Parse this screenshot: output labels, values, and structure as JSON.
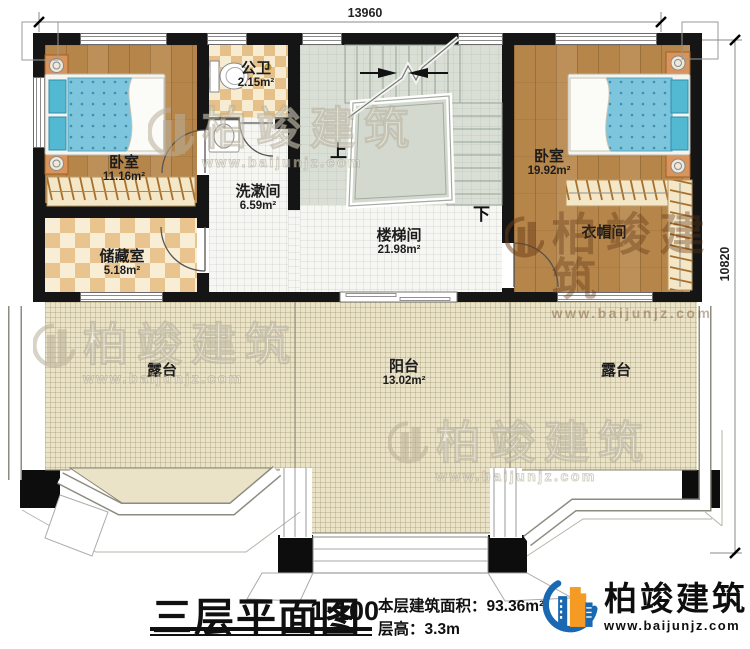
{
  "plan": {
    "title": "三层平面图",
    "scale": "1:100",
    "area_label": "本层建筑面积：",
    "area_value": "93.36m²",
    "height_label": "层高：",
    "height_value": "3.3m",
    "dimensions": {
      "top": "13960",
      "right": "10820"
    },
    "rooms": {
      "bedroom1": {
        "name": "卧室",
        "area": "11.16m²"
      },
      "bath": {
        "name": "公卫",
        "area": "2.15m²"
      },
      "wash": {
        "name": "洗漱间",
        "area": "6.59m²"
      },
      "stairwell": {
        "name": "楼梯间",
        "area": "21.98m²"
      },
      "bedroom2": {
        "name": "卧室",
        "area": "19.92m²"
      },
      "cloak": {
        "name": "衣帽间"
      },
      "storage": {
        "name": "储藏室",
        "area": "5.18m²"
      },
      "terrace_left": {
        "name": "露台"
      },
      "balcony": {
        "name": "阳台",
        "area": "13.02m²"
      },
      "terrace_right": {
        "name": "露台"
      }
    },
    "stairs": {
      "up": "上",
      "down": "下"
    }
  },
  "branding": {
    "logo_text": "柏竣建筑",
    "logo_url": "www.baijunjz.com",
    "watermark_text": "柏竣建筑",
    "watermark_url": "www.baijunjz.com"
  },
  "colors": {
    "wall": "#151515",
    "wood_floor": "#b5854a",
    "terrace_floor": "#ebe3c8",
    "stair_floor": "#d9dfd5",
    "checker_tan": "#e6c089",
    "bed_blue": "#7cc5dc",
    "logo_blue": "#1a68b2",
    "logo_orange": "#f59a23"
  }
}
